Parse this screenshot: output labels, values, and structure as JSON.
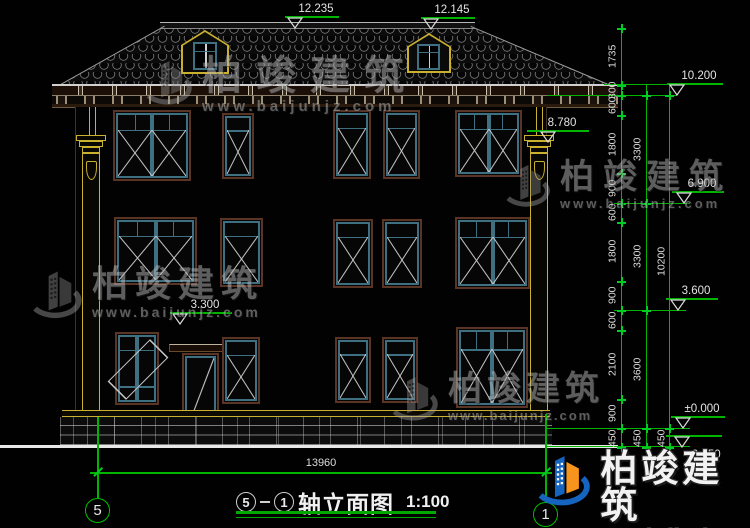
{
  "drawing": {
    "title_axis_start": "5",
    "title_axis_dash": "—",
    "title_axis_end": "1",
    "title_text": "轴立面图",
    "title_scale": "1:100",
    "axis_left_bubble": "5",
    "axis_right_bubble": "1",
    "total_width_dim": "13960"
  },
  "elevation_markers": [
    {
      "id": "main-ridge",
      "label": "12.235"
    },
    {
      "id": "dormer-ridge",
      "label": "12.145"
    },
    {
      "id": "eave-top",
      "label": "10.200"
    },
    {
      "id": "pilaster-top",
      "label": "8.780"
    },
    {
      "id": "floor3-level",
      "label": "6.900"
    },
    {
      "id": "floor2-level",
      "label": "3.600"
    },
    {
      "id": "floor2-interior",
      "label": "3.300"
    },
    {
      "id": "ground-floor",
      "label": "±0.000"
    },
    {
      "id": "site-ground",
      "label": "-0.450"
    }
  ],
  "dimension_chains": {
    "inner": [
      "1735",
      "300",
      "600",
      "1800",
      "900",
      "600",
      "1800",
      "900",
      "600",
      "2100",
      "900"
    ],
    "floors": [
      "3300",
      "3300",
      "3600"
    ],
    "total": [
      "10200"
    ],
    "base": [
      "450",
      "450",
      "450"
    ]
  },
  "watermark": {
    "brand": "柏竣建筑",
    "url": "www.baijunjz.com"
  },
  "colors": {
    "dimension_green": "#00b400",
    "pilaster_yellow": "#c9b02e",
    "frame_teal": "#3f7082",
    "frame_brown": "#5a3526",
    "logo_blue": "#1565c0",
    "logo_orange": "#f7941d"
  }
}
